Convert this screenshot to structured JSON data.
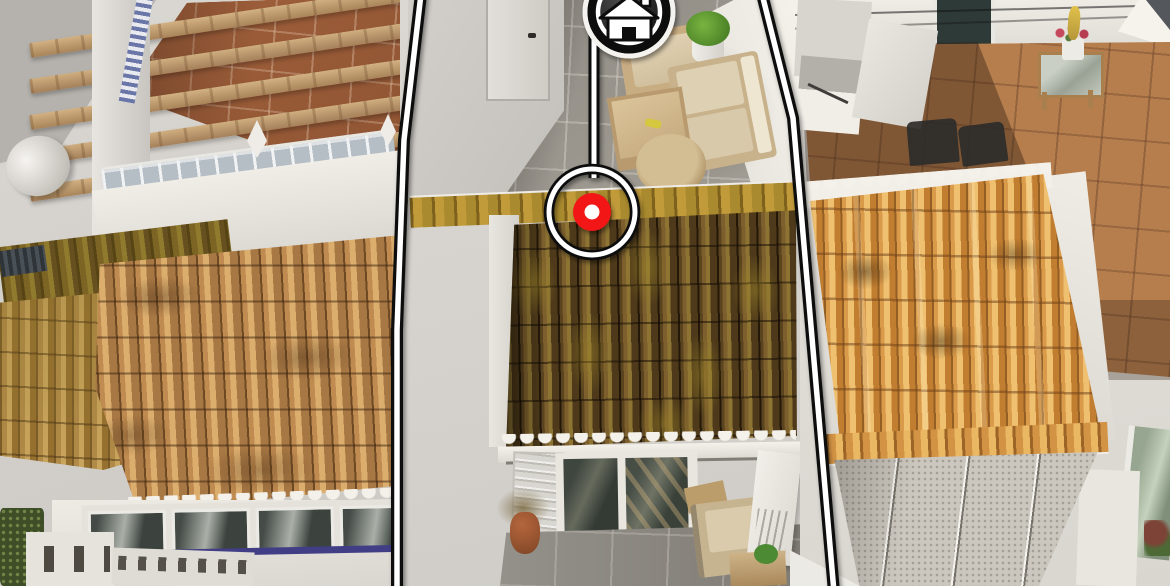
{
  "meta": {
    "canvas_width": 1170,
    "canvas_height": 586,
    "content_type": "aerial-photo-with-property-overlay"
  },
  "overlay": {
    "property_boundary": {
      "stroke_outer": "#0d0d0d",
      "stroke_inner": "#ffffff"
    },
    "connector": {
      "stroke_outer": "#0d0d0d",
      "stroke_inner": "#ffffff"
    },
    "house_badge": {
      "icon": "house-icon",
      "halo": "#f5f3ef",
      "ring_outer": "#0d0d0d",
      "ring_inner": "#ffffff",
      "glyph_fill": "#ffffff",
      "glyph_outline": "#0d0d0d",
      "door_fill": "#0d0d0d"
    },
    "location_marker": {
      "icon": "location-marker-icon",
      "ring_outer": "#0d0d0d",
      "ring_inner": "#ffffff",
      "dot": "#f21414",
      "dot_center": "#ffffff"
    }
  },
  "scene": {
    "left_property": [
      "pergola-terrace",
      "glass-block-balustrade",
      "tan-tile-roof",
      "window-facade"
    ],
    "highlighted_property": [
      "gray-tile-roof-terrace",
      "outdoor-lounge-set",
      "tiled-staircase",
      "moss-covered-tile-roof",
      "lower-patio-glass-doors"
    ],
    "right_property": [
      "terracotta-terrace",
      "orange-tile-roof",
      "flat-panel-roof"
    ]
  }
}
